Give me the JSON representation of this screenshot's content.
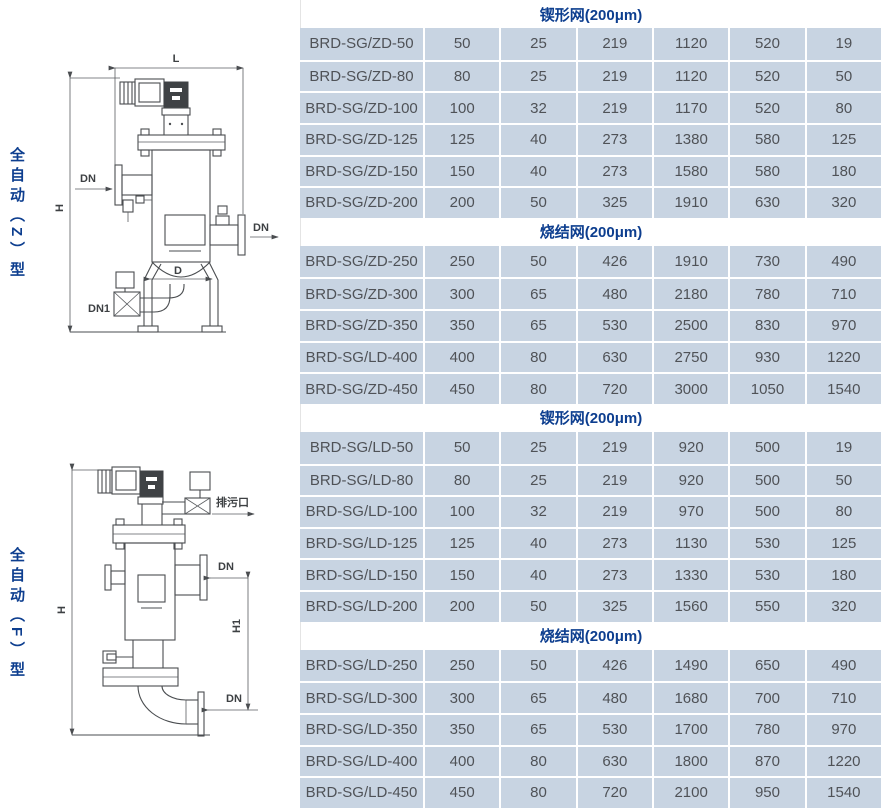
{
  "page": {
    "accent_blue": "#0d3e8f",
    "row_bg": "#c8d4e2",
    "cell_text_color": "#4f5257"
  },
  "left_panel": {
    "z_type_label": "全自动（Z）型",
    "f_type_label": "全自动（F）型",
    "diagram_z": {
      "labels": {
        "L": "L",
        "H": "H",
        "dn_in": "DN",
        "dn_out": "DN",
        "d": "D",
        "dn1": "DN1"
      }
    },
    "diagram_f": {
      "labels": {
        "drain": "排污口",
        "dn_side": "DN",
        "dn_bottom": "DN",
        "h": "H",
        "h1": "H1"
      }
    }
  },
  "tables": [
    {
      "header": "锲形网(200μm)",
      "rows": [
        [
          "BRD-SG/ZD-50",
          "50",
          "25",
          "219",
          "1120",
          "520",
          "19"
        ],
        [
          "BRD-SG/ZD-80",
          "80",
          "25",
          "219",
          "1120",
          "520",
          "50"
        ],
        [
          "BRD-SG/ZD-100",
          "100",
          "32",
          "219",
          "1170",
          "520",
          "80"
        ],
        [
          "BRD-SG/ZD-125",
          "125",
          "40",
          "273",
          "1380",
          "580",
          "125"
        ],
        [
          "BRD-SG/ZD-150",
          "150",
          "40",
          "273",
          "1580",
          "580",
          "180"
        ],
        [
          "BRD-SG/ZD-200",
          "200",
          "50",
          "325",
          "1910",
          "630",
          "320"
        ]
      ]
    },
    {
      "header": "烧结网(200μm)",
      "rows": [
        [
          "BRD-SG/ZD-250",
          "250",
          "50",
          "426",
          "1910",
          "730",
          "490"
        ],
        [
          "BRD-SG/ZD-300",
          "300",
          "65",
          "480",
          "2180",
          "780",
          "710"
        ],
        [
          "BRD-SG/ZD-350",
          "350",
          "65",
          "530",
          "2500",
          "830",
          "970"
        ],
        [
          "BRD-SG/LD-400",
          "400",
          "80",
          "630",
          "2750",
          "930",
          "1220"
        ],
        [
          "BRD-SG/ZD-450",
          "450",
          "80",
          "720",
          "3000",
          "1050",
          "1540"
        ]
      ]
    },
    {
      "header": "锲形网(200μm)",
      "rows": [
        [
          "BRD-SG/LD-50",
          "50",
          "25",
          "219",
          "920",
          "500",
          "19"
        ],
        [
          "BRD-SG/LD-80",
          "80",
          "25",
          "219",
          "920",
          "500",
          "50"
        ],
        [
          "BRD-SG/LD-100",
          "100",
          "32",
          "219",
          "970",
          "500",
          "80"
        ],
        [
          "BRD-SG/LD-125",
          "125",
          "40",
          "273",
          "1130",
          "530",
          "125"
        ],
        [
          "BRD-SG/LD-150",
          "150",
          "40",
          "273",
          "1330",
          "530",
          "180"
        ],
        [
          "BRD-SG/LD-200",
          "200",
          "50",
          "325",
          "1560",
          "550",
          "320"
        ]
      ]
    },
    {
      "header": "烧结网(200μm)",
      "rows": [
        [
          "BRD-SG/LD-250",
          "250",
          "50",
          "426",
          "1490",
          "650",
          "490"
        ],
        [
          "BRD-SG/LD-300",
          "300",
          "65",
          "480",
          "1680",
          "700",
          "710"
        ],
        [
          "BRD-SG/LD-350",
          "350",
          "65",
          "530",
          "1700",
          "780",
          "970"
        ],
        [
          "BRD-SG/LD-400",
          "400",
          "80",
          "630",
          "1800",
          "870",
          "1220"
        ],
        [
          "BRD-SG/LD-450",
          "450",
          "80",
          "720",
          "2100",
          "950",
          "1540"
        ]
      ]
    }
  ]
}
